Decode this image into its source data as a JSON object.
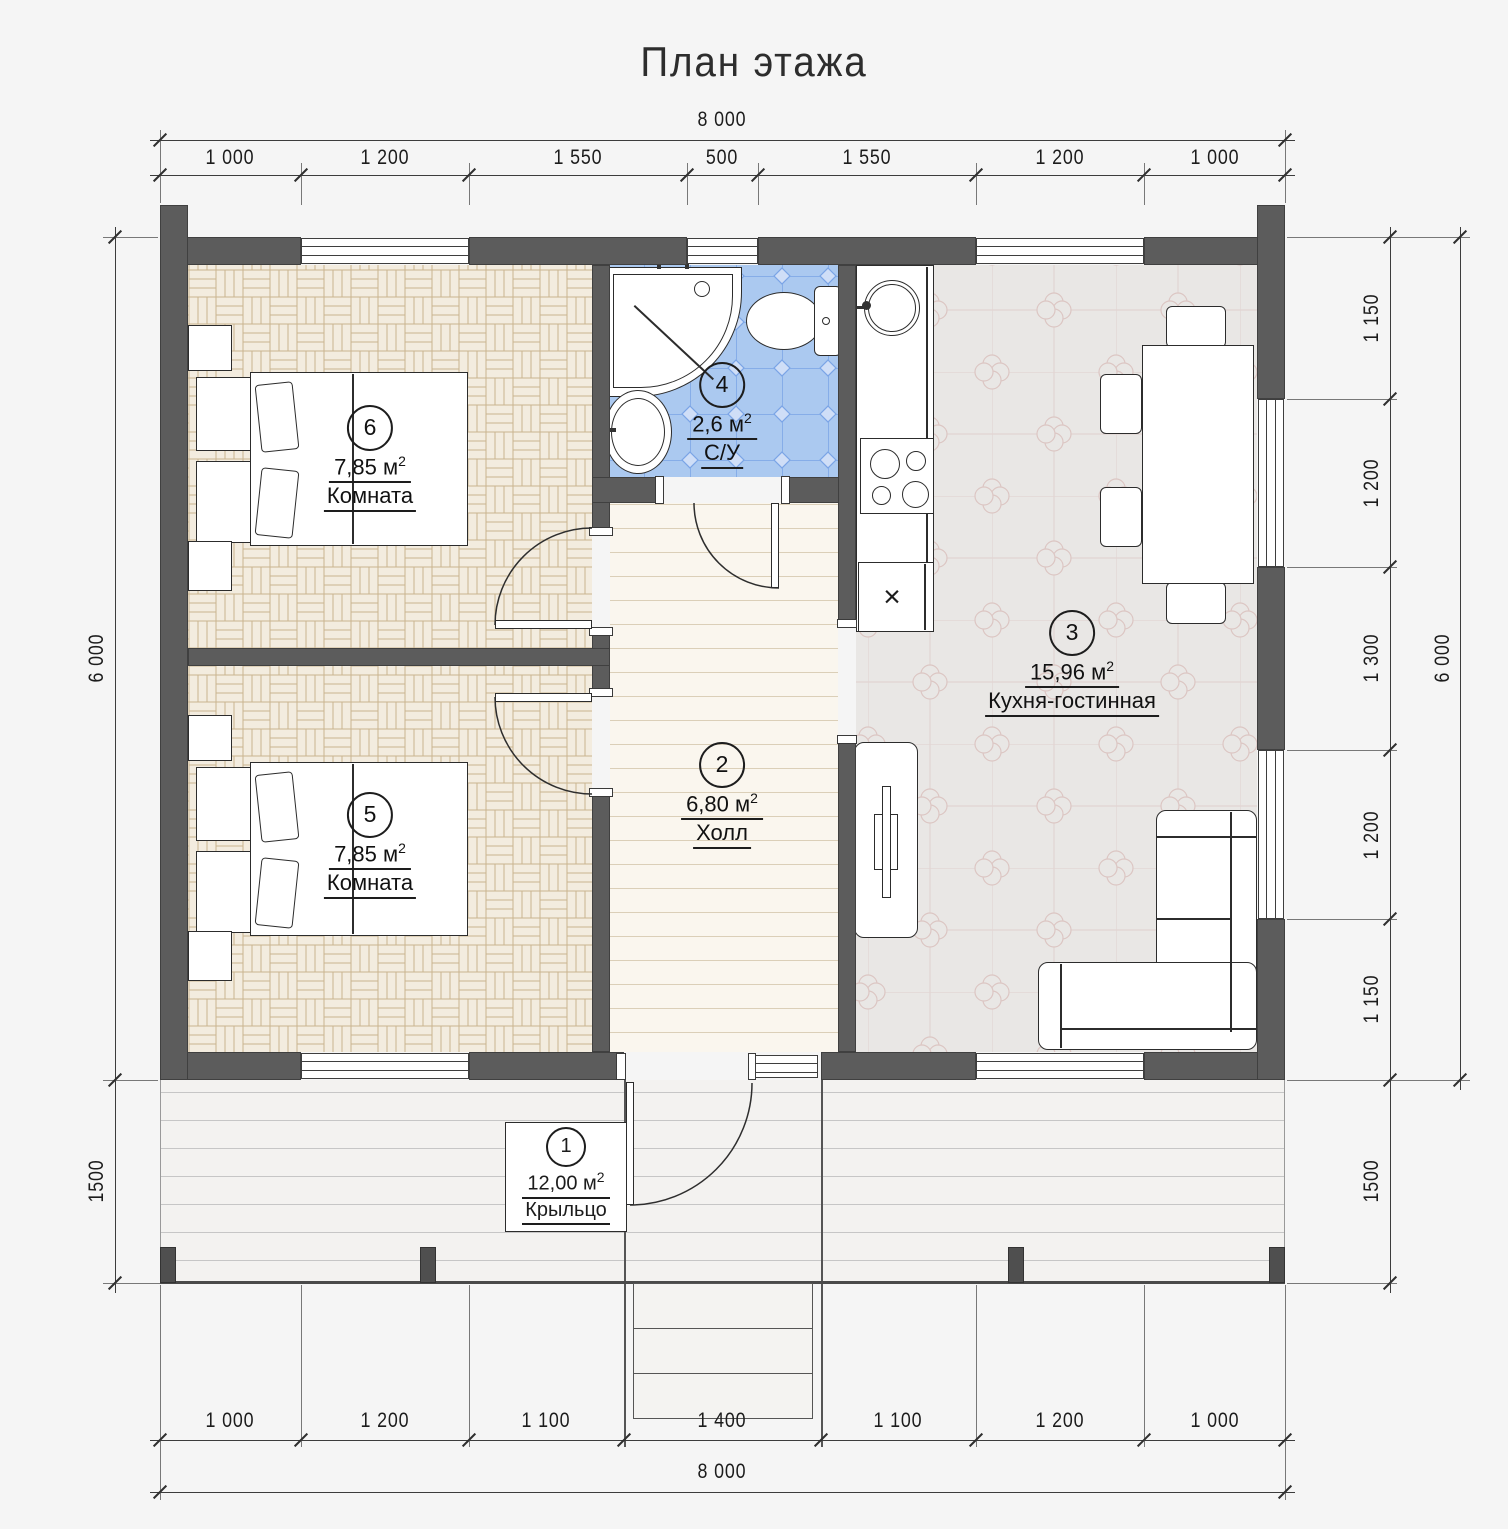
{
  "title": "План этажа",
  "dimensions": {
    "top": {
      "overall": "8 000",
      "segments": [
        "1 000",
        "1 200",
        "1 550",
        "500",
        "1 550",
        "1 200",
        "1 000"
      ]
    },
    "bottom": {
      "overall": "8 000",
      "segments": [
        "1 000",
        "1 200",
        "1 100",
        "1 400",
        "1 100",
        "1 200",
        "1 000"
      ]
    },
    "left": {
      "overall": "6 000",
      "porch": "1500"
    },
    "right": {
      "overall": "6 000",
      "porch": "1500",
      "segments": [
        "1 150",
        "1 200",
        "1 300",
        "1 200",
        "1 150"
      ]
    }
  },
  "rooms": [
    {
      "number": "1",
      "area": "12,00 м",
      "sup": "2",
      "name": "Крыльцо"
    },
    {
      "number": "2",
      "area": "6,80 м",
      "sup": "2",
      "name": "Холл"
    },
    {
      "number": "3",
      "area": "15,96 м",
      "sup": "2",
      "name": "Кухня-гостинная"
    },
    {
      "number": "4",
      "area": "2,6 м",
      "sup": "2",
      "name": "С/У"
    },
    {
      "number": "5",
      "area": "7,85 м",
      "sup": "2",
      "name": "Комната"
    },
    {
      "number": "6",
      "area": "7,85 м",
      "sup": "2",
      "name": "Комната"
    }
  ],
  "kitchen": {
    "cabinet_mark": "×"
  },
  "colors": {
    "background": "#f5f5f5",
    "wall": "#5c5c5c",
    "bathroom_tile": "#abc9f0",
    "parquet": "#f3ecdf",
    "kitchen_floor": "#e9e7e5",
    "line": "#3c3c3c"
  }
}
